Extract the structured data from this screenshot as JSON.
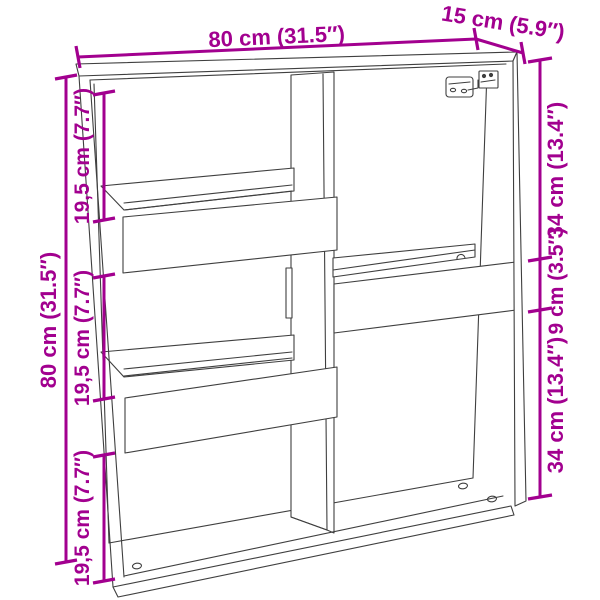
{
  "page": {
    "background": "#ffffff"
  },
  "diagram": {
    "subject": "wall-cabinet-dimension-drawing",
    "accent_color": "#A2008F",
    "line_color": "#3F3F3F",
    "dimensions": {
      "top_width": "80 cm (31.5″)",
      "top_depth": "15 cm (5.9″)",
      "left_total_height": "80 cm (31.5″)",
      "left_segments": [
        "19,5 cm (7.7″)",
        "19,5 cm (7.7″)",
        "19,5 cm (7.7″)"
      ],
      "right_segments": [
        "34 cm (13.4″)",
        "9 cm (3.5″)",
        "34 cm (13.4″)"
      ]
    }
  }
}
